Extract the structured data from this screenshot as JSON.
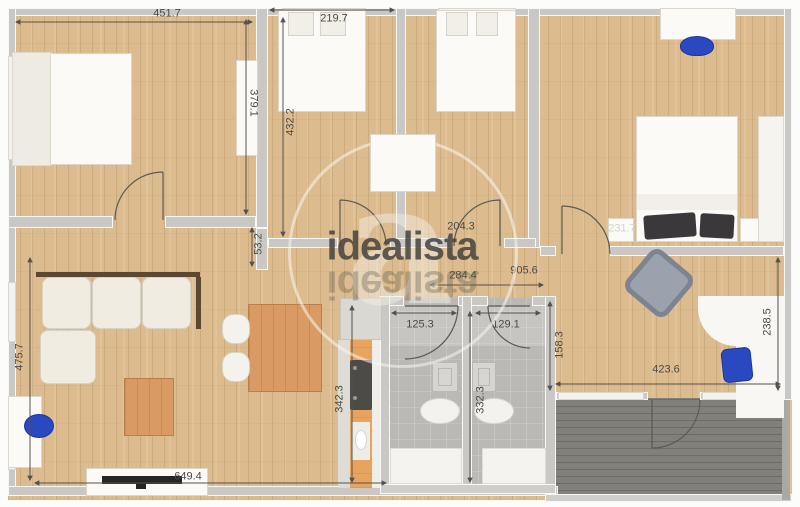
{
  "watermark": {
    "brand_text": "idealista",
    "glyph": "a"
  },
  "measurements": {
    "bedroom1_width": "451.7",
    "bedroom2_width": "219.7",
    "bedroom1_height": "379.1",
    "bedroom2_height": "432.2",
    "wall_stub": "53.2",
    "hall_upper": "204.3",
    "hall_lower": "284.4",
    "corridor_total": "905.6",
    "bath_left_width": "125.3",
    "bath_right_width": "129.1",
    "office_left_height": "158.3",
    "bath_height": "332.3",
    "kitchen_height": "342.3",
    "office_width": "423.6",
    "office_right_height": "238.5",
    "living_height": "475.7",
    "living_width": "649.4",
    "bed_width": "231.7"
  },
  "colors": {
    "wood_floor": "#dcbc8e",
    "wall_gray": "#c9c8c4",
    "bathroom_floor": "#bab9b5",
    "terrace_deck": "#82807a",
    "kitchen_counter": "#e8a35f",
    "chair_blue": "#2a49c0",
    "armchair_gray": "#99a2ad",
    "watermark_text": "#45433f"
  },
  "furniture": [
    "double-bed",
    "single-bed",
    "single-bed",
    "double-bed-with-dark-pillows",
    "wardrobe",
    "dresser",
    "desk",
    "blue-desk-chair",
    "corner-sofa",
    "coffee-table",
    "dining-table",
    "dining-chairs",
    "tv-stand",
    "tv",
    "kitchen-counter",
    "stove",
    "sink",
    "shower",
    "toilet",
    "bathtub",
    "gray-armchair",
    "l-shaped-desk",
    "terrace-deck"
  ]
}
